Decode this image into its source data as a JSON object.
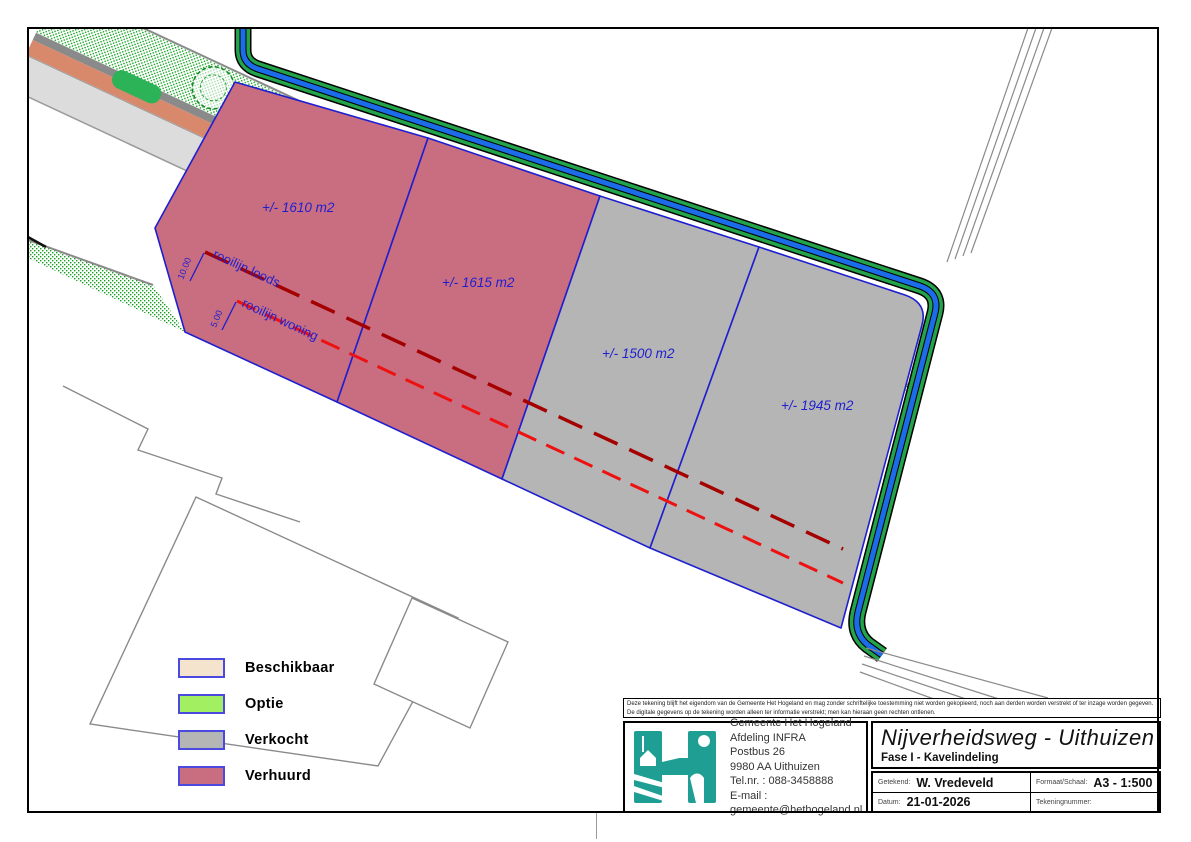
{
  "map": {
    "street_label": "Nijverheidsweg",
    "parcels": [
      {
        "area_label": "+/- 1610 m2",
        "status": "Verhuurd"
      },
      {
        "area_label": "+/- 1615 m2",
        "status": "Verhuurd"
      },
      {
        "area_label": "+/- 1500 m2",
        "status": "Verkocht"
      },
      {
        "area_label": "+/- 1945 m2",
        "status": "Verkocht"
      }
    ],
    "rooilijn_loods_label": "rooilijn loods",
    "rooilijn_woning_label": "rooilijn woning",
    "dim_loods": "10.00",
    "dim_woning": "5.00"
  },
  "legend": {
    "items": [
      {
        "label": "Beschikbaar",
        "color": "#f4e4ce"
      },
      {
        "label": "Optie",
        "color": "#a2ef62"
      },
      {
        "label": "Verkocht",
        "color": "#b5b5b5"
      },
      {
        "label": "Verhuurd",
        "color": "#c96d80"
      }
    ]
  },
  "title_block": {
    "disclaimer_line1": "Deze tekening blijft het eigendom van de Gemeente Het Hogeland en mag zonder schriftelijke toestemming niet worden gekopieerd, noch aan derden worden verstrekt of ter inzage worden gegeven.",
    "disclaimer_line2": "De digitale gegevens op de tekening worden alleen ter informatie verstrekt; men kan hieraan geen rechten ontlenen.",
    "organization": {
      "name": "Gemeente Het Hogeland",
      "department": "Afdeling INFRA",
      "address_line1": "Postbus 26",
      "address_line2": "9980 AA Uithuizen",
      "phone": "Tel.nr. : 088-3458888",
      "email": "E-mail : gemeente@hethogeland.nl"
    },
    "title": "Nijverheidsweg - Uithuizen",
    "subtitle": "Fase I - Kavelindeling",
    "fields": {
      "drawn_label": "Getekend:",
      "drawn_value": "W. Vredeveld",
      "format_label": "Formaat/Schaal:",
      "format_value": "A3 - 1:500",
      "date_label": "Datum:",
      "date_value": "21-01-2026",
      "number_label": "Tekeningnummer:",
      "number_value": ""
    }
  },
  "colors": {
    "parcel_rented": "#c96d80",
    "parcel_sold": "#b5b5b5",
    "ditch_green": "#23a44a",
    "ditch_water_blue": "#1c6be8",
    "verge_dot_green": "#12a01e",
    "cycle_path_salmon": "#d8896b",
    "road_gray": "#dcdcdc",
    "curb_gray": "#8a8a8a",
    "boundary_blue": "#1f1fd0",
    "rooilijn_loods_red": "#a50000",
    "rooilijn_woning_red": "#ee1111",
    "logo_teal": "#1f9e93"
  }
}
